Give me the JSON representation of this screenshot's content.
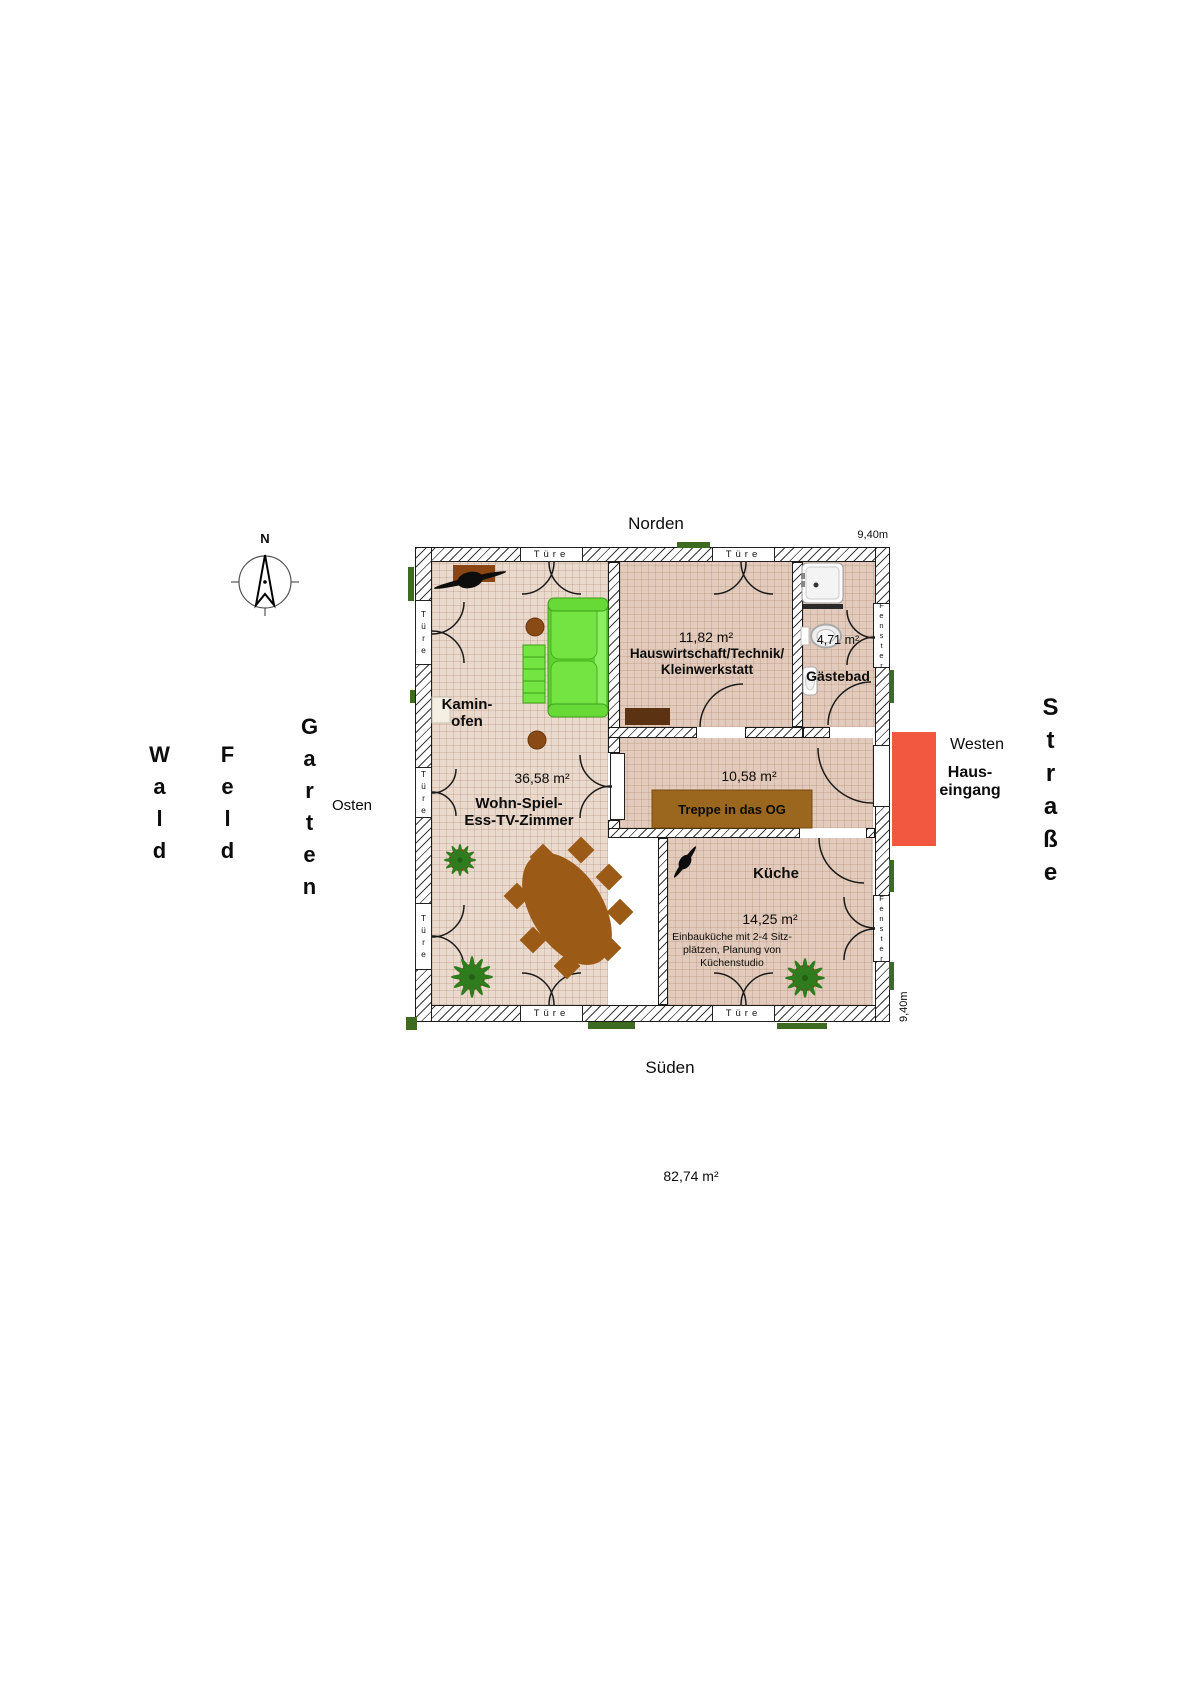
{
  "compass": {
    "n": "N"
  },
  "directions": {
    "north": "Norden",
    "south": "Süden",
    "east": "Osten",
    "west": "Westen"
  },
  "surroundings": {
    "wald": "Wald",
    "feld": "Feld",
    "garten": "Garten",
    "strasse": "Straße"
  },
  "entrance": {
    "line1": "Haus-",
    "line2": "eingang"
  },
  "dimensions": {
    "top": "9,40m",
    "right": "9,40m",
    "total": "82,74 m²"
  },
  "openings": {
    "door": "Türe",
    "window": "Fenster"
  },
  "rooms": {
    "living": {
      "area": "36,58 m²",
      "line1": "Wohn-Spiel-",
      "line2": "Ess-TV-Zimmer",
      "kamin1": "Kamin-",
      "kamin2": "ofen"
    },
    "utility": {
      "area": "11,82 m²",
      "line1": "Hauswirtschaft/Technik/",
      "line2": "Kleinwerkstatt"
    },
    "bath": {
      "area": "4,71 m²",
      "name": "Gästebad"
    },
    "hall": {
      "area": "10,58 m²",
      "stairs": "Treppe in das OG"
    },
    "kitchen": {
      "name": "Küche",
      "area": "14,25 m²",
      "note1": "Einbauküche mit 2-4 Sitz-",
      "note2": "plätzen, Planung von",
      "note3": "Küchenstudio"
    }
  },
  "colors": {
    "entrance_red": "#f2573f",
    "sofa_green": "#74e442",
    "wood_brown": "#9c5a17",
    "stairs_brown": "#9b661e",
    "floor_light": "#ead9cd",
    "floor_dark": "#e2cbbc",
    "plant_green": "#2e7c1e"
  }
}
